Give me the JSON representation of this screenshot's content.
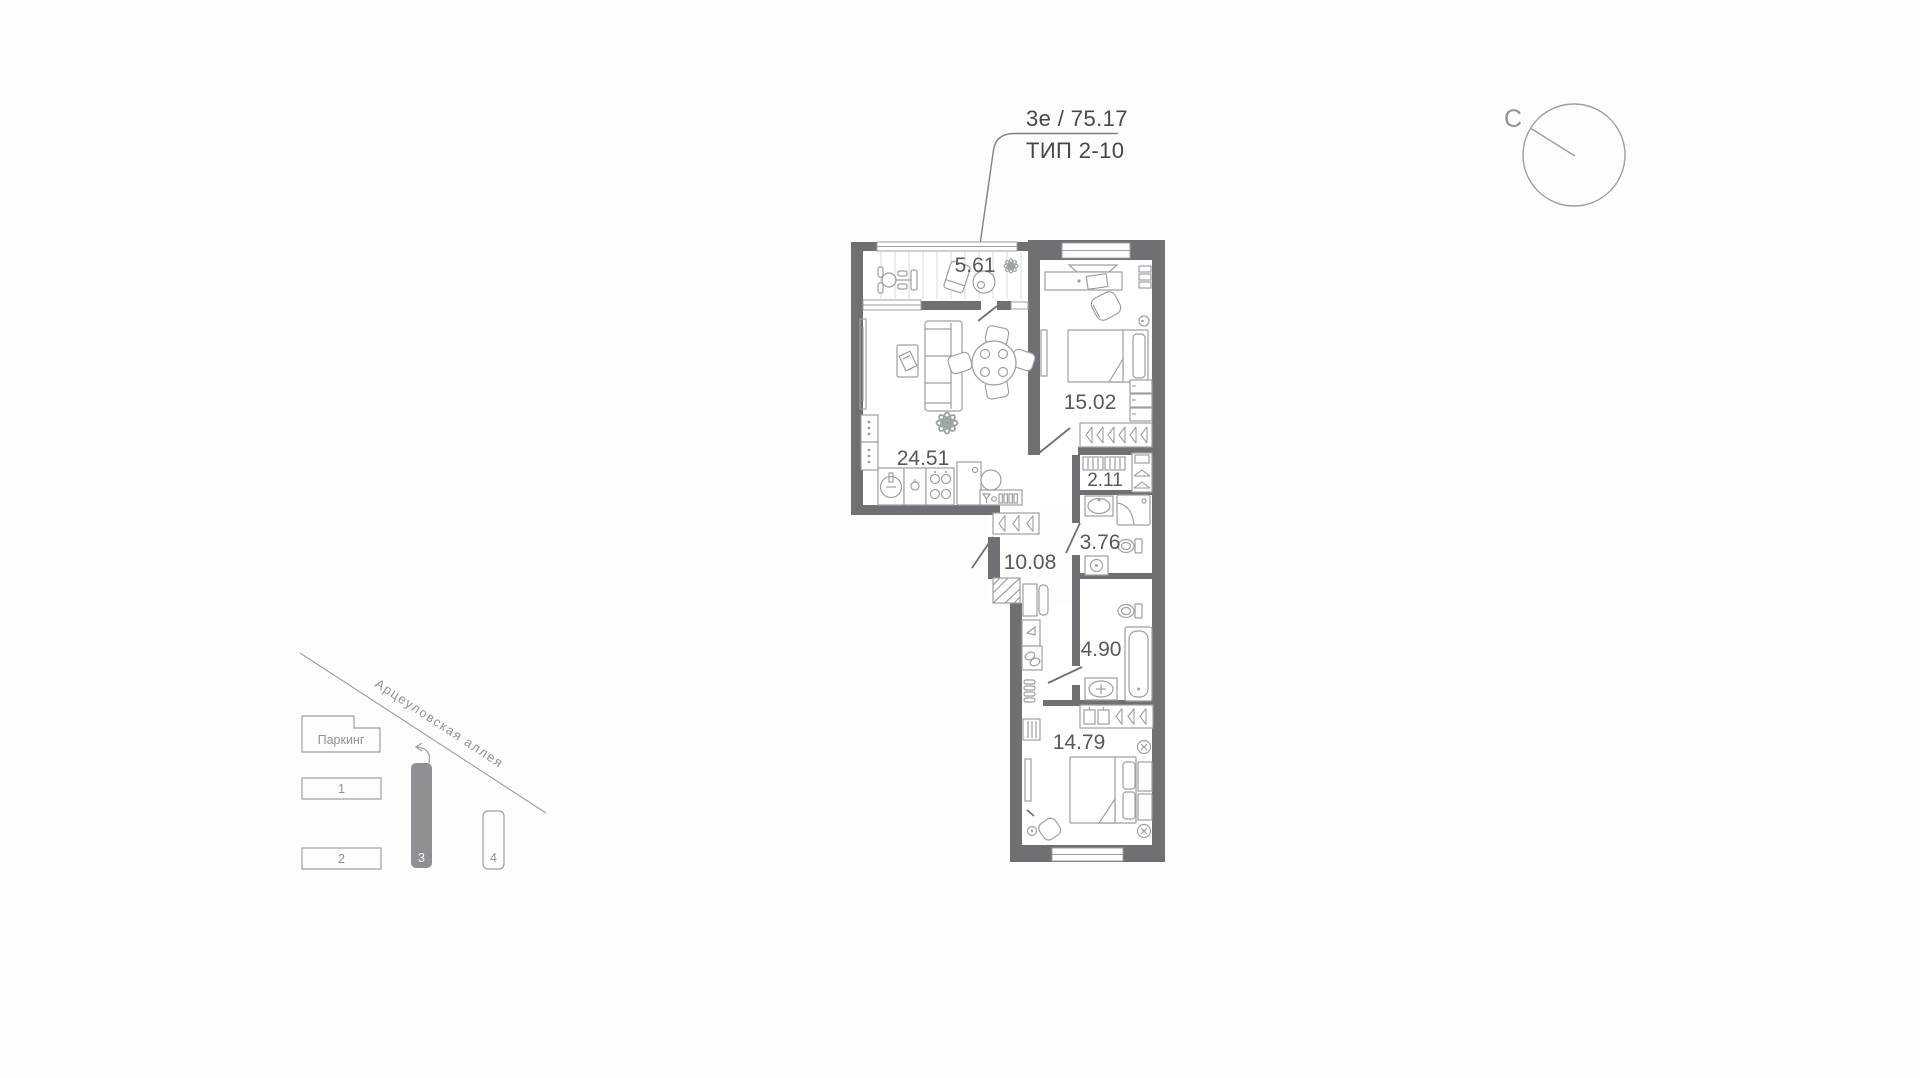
{
  "header": {
    "area_label": "3е / 75.17",
    "type_label": "ТИП 2-10"
  },
  "compass": {
    "north_label": "С"
  },
  "plan": {
    "rooms": [
      {
        "id": "balcony",
        "area": "5.61"
      },
      {
        "id": "bedroom-1",
        "area": "15.02"
      },
      {
        "id": "living-kitchen",
        "area": "24.51"
      },
      {
        "id": "wardrobe",
        "area": "2.11"
      },
      {
        "id": "bathroom-1",
        "area": "3.76"
      },
      {
        "id": "hallway",
        "area": "10.08"
      },
      {
        "id": "bathroom-2",
        "area": "4.90"
      },
      {
        "id": "bedroom-2",
        "area": "14.79"
      }
    ]
  },
  "minimap": {
    "street_label": "Арцеуловская аллея",
    "parking_label": "Паркинг",
    "buildings": [
      {
        "label": "1",
        "active": false
      },
      {
        "label": "2",
        "active": false
      },
      {
        "label": "3",
        "active": true
      },
      {
        "label": "4",
        "active": false
      }
    ]
  },
  "colors": {
    "wall": "#6e7073",
    "furniture_stroke": "#9ba0a3",
    "room_label": "#55595c",
    "title_text": "#44484b",
    "background": "#fcfdfd",
    "background_dot": "#babdbe",
    "active_building": "#8d9194"
  }
}
